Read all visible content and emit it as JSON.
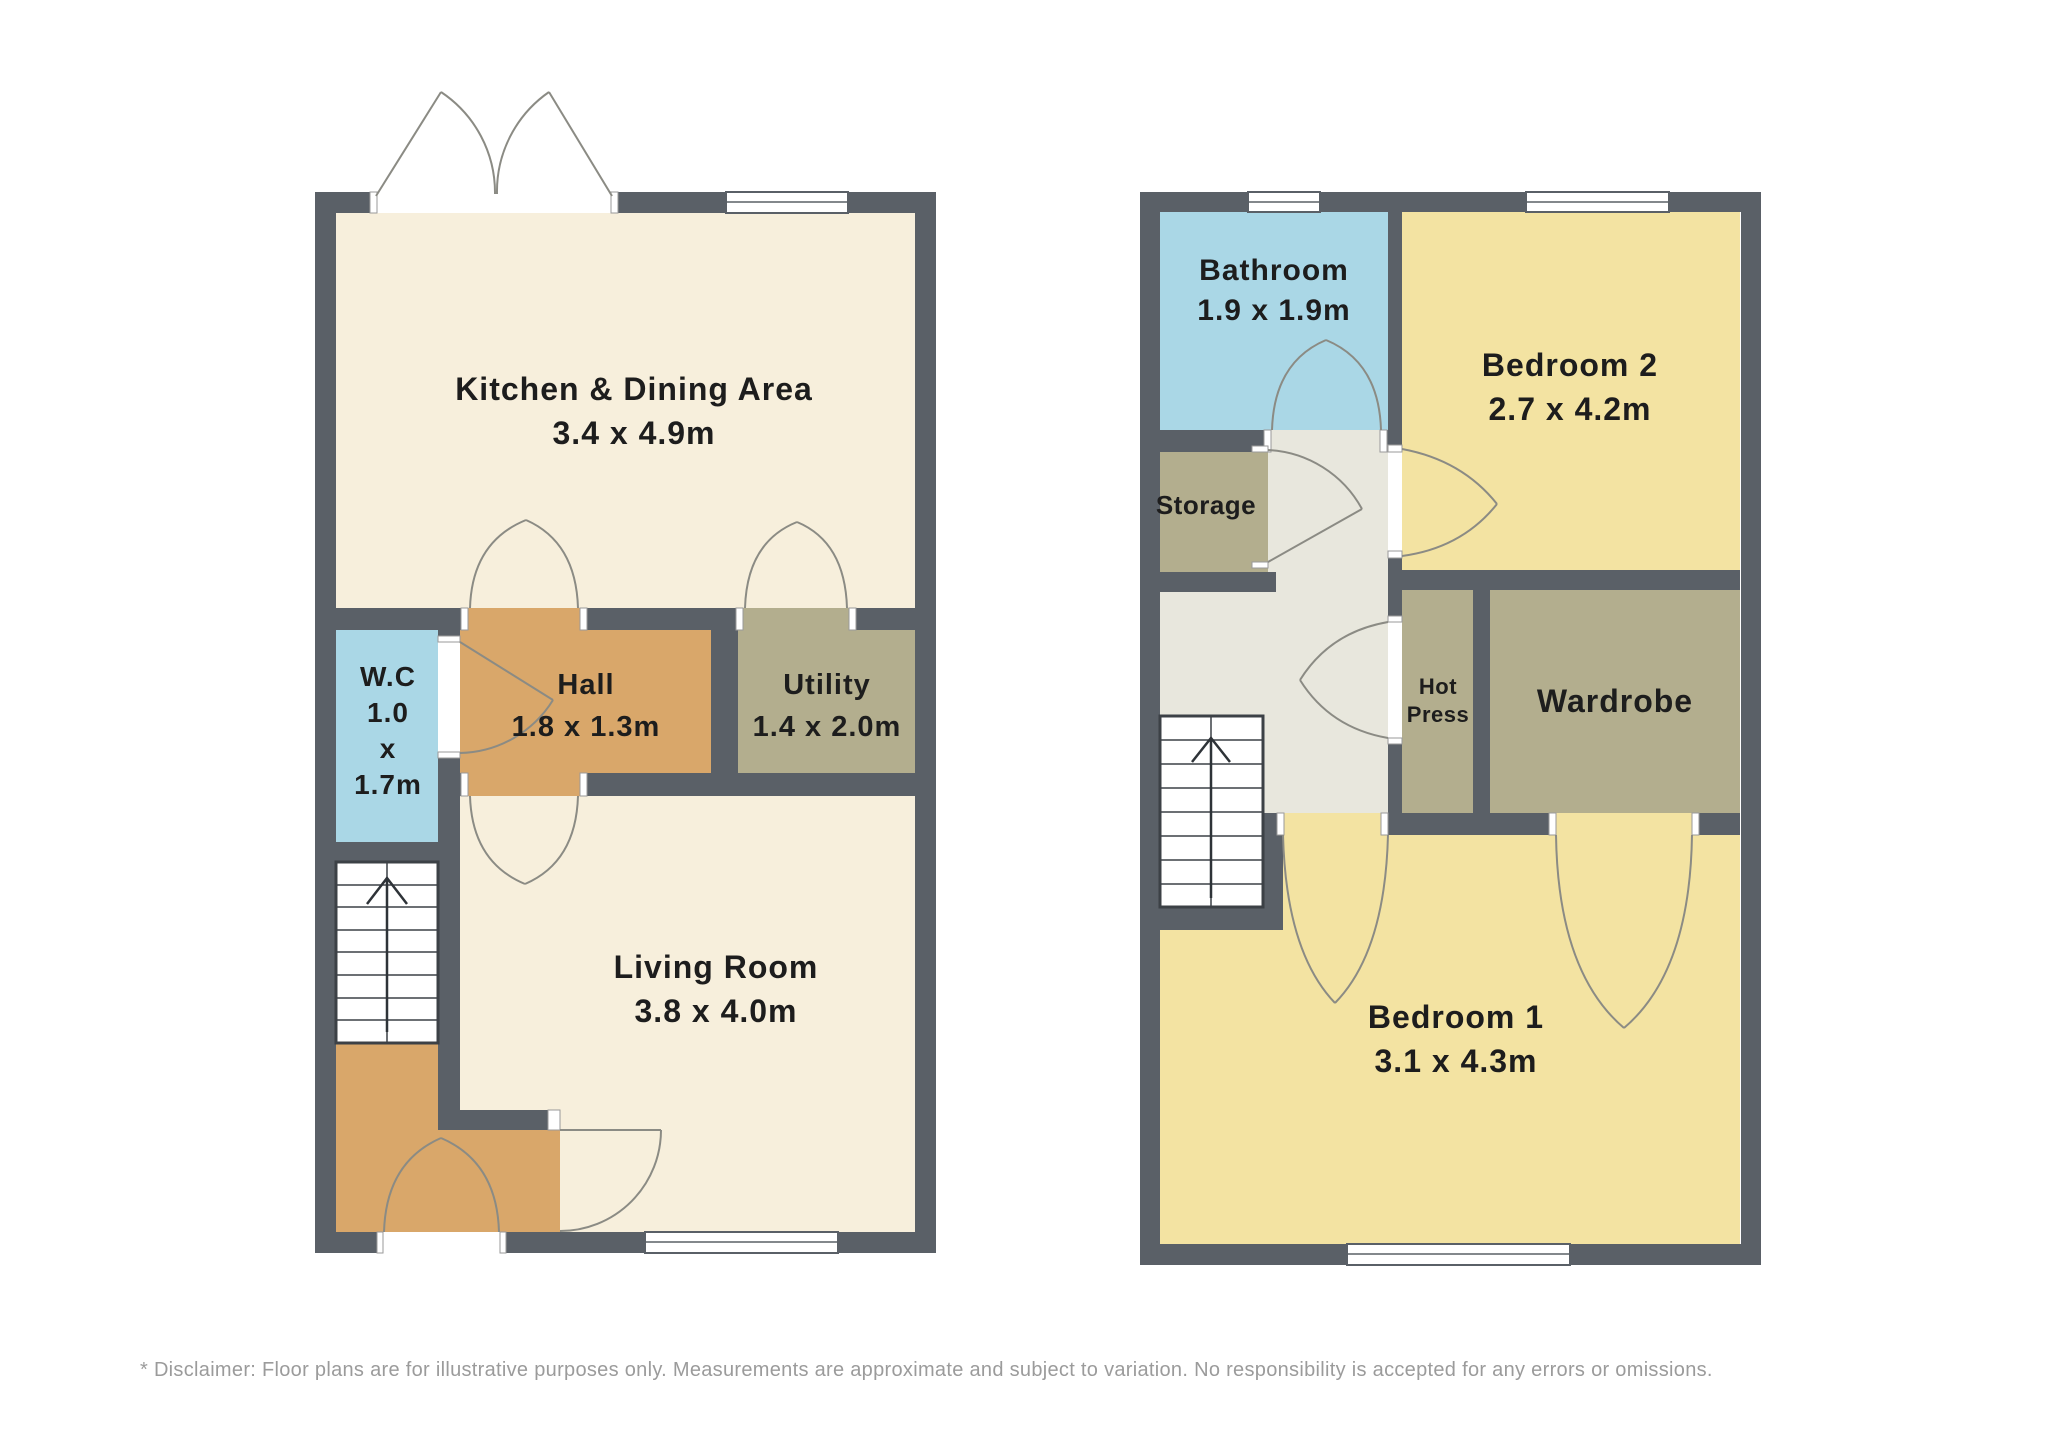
{
  "plans": {
    "ground": {
      "rooms": {
        "kitchen": {
          "line1": "Kitchen & Dining Area",
          "line2": "3.4 x 4.9m"
        },
        "wc": {
          "line1": "W.C",
          "line2": "1.0",
          "line3": "x",
          "line4": "1.7m"
        },
        "hall": {
          "line1": "Hall",
          "line2": "1.8 x 1.3m"
        },
        "utility": {
          "line1": "Utility",
          "line2": "1.4 x 2.0m"
        },
        "living": {
          "line1": "Living Room",
          "line2": "3.8 x 4.0m"
        }
      }
    },
    "first": {
      "rooms": {
        "bathroom": {
          "line1": "Bathroom",
          "line2": "1.9 x 1.9m"
        },
        "bedroom2": {
          "line1": "Bedroom 2",
          "line2": "2.7 x 4.2m"
        },
        "storage": {
          "line1": "Storage"
        },
        "hot_press": {
          "line1": "Hot",
          "line2": "Press"
        },
        "wardrobe": {
          "line1": "Wardrobe"
        },
        "bedroom1": {
          "line1": "Bedroom 1",
          "line2": "3.1 x 4.3m"
        }
      }
    }
  },
  "disclaimer": "* Disclaimer: Floor plans are for illustrative purposes only. Measurements are approximate and subject to variation. No responsibility is accepted for any errors or omissions.",
  "colors": {
    "wall": "#5a6067",
    "cream_room": "#f7efdc",
    "blue_room": "#aad7e6",
    "orange_room": "#d9a76a",
    "olive_room": "#b3ae8e",
    "yellow_room": "#f3e3a2",
    "landing": "#e8e7dd",
    "door_arc": "#8b8b84",
    "label_text": "#1d1d1d",
    "disclaimer_text": "#9b9b9b"
  }
}
